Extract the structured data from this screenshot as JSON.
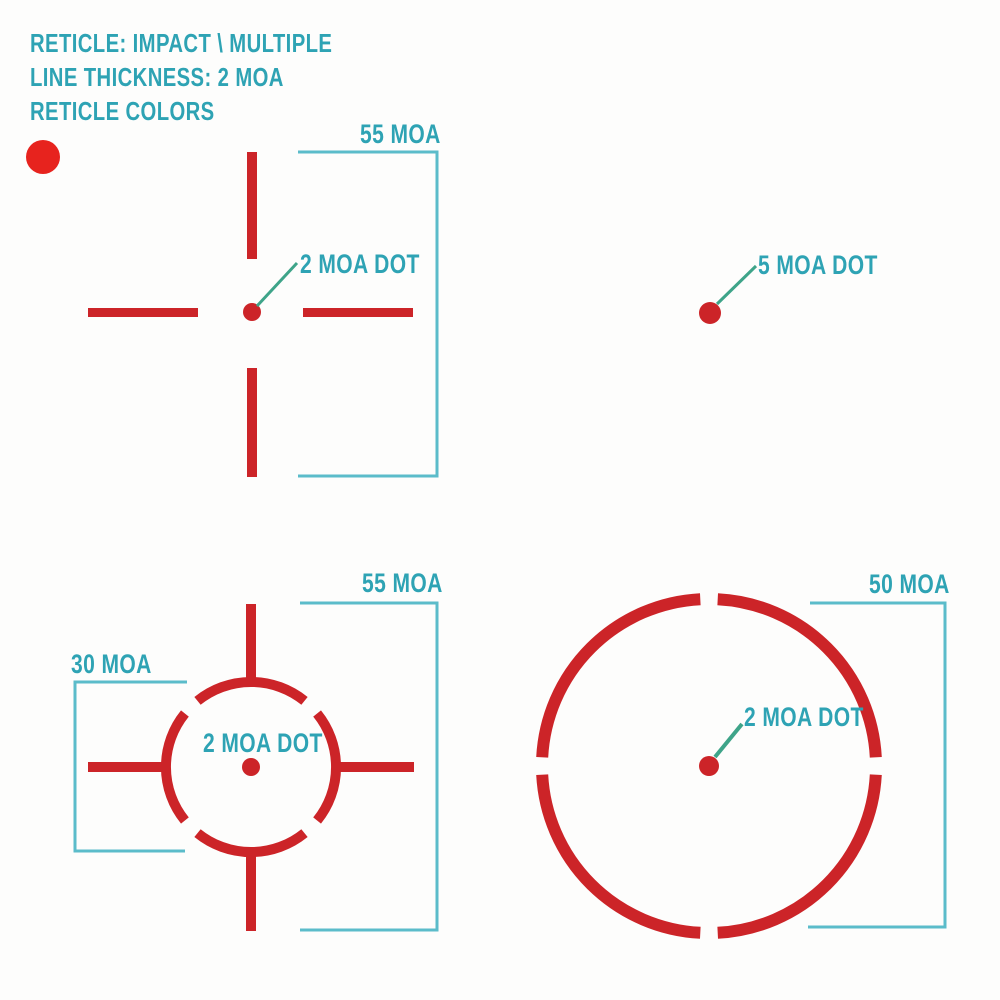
{
  "header": {
    "line1": "RETICLE: IMPACT \\ MULTIPLE",
    "line2": "LINE THICKNESS: 2 MOA",
    "line3": "RETICLE COLORS"
  },
  "color_options": {
    "swatch_name": "red"
  },
  "colors": {
    "reticle_red": "#cc2428",
    "swatch_red": "#e7231e",
    "label_teal": "#2ea3b4",
    "bracket_teal": "#5bbcca",
    "leader_green": "#3ea489",
    "background": "#fdfdfc"
  },
  "reticle_crosshair": {
    "description": "crosshair with center dot",
    "span_label": "55 MOA",
    "dot_label": "2 MOA DOT"
  },
  "reticle_dot": {
    "description": "single dot",
    "dot_label": "5 MOA DOT"
  },
  "reticle_circle_crosshair": {
    "description": "segmented circle with crosshair and center dot",
    "span_label": "55 MOA",
    "circle_label": "30 MOA",
    "dot_label": "2 MOA DOT"
  },
  "reticle_circle_dot": {
    "description": "segmented circle with center dot",
    "span_label": "50 MOA",
    "dot_label": "2 MOA DOT"
  }
}
